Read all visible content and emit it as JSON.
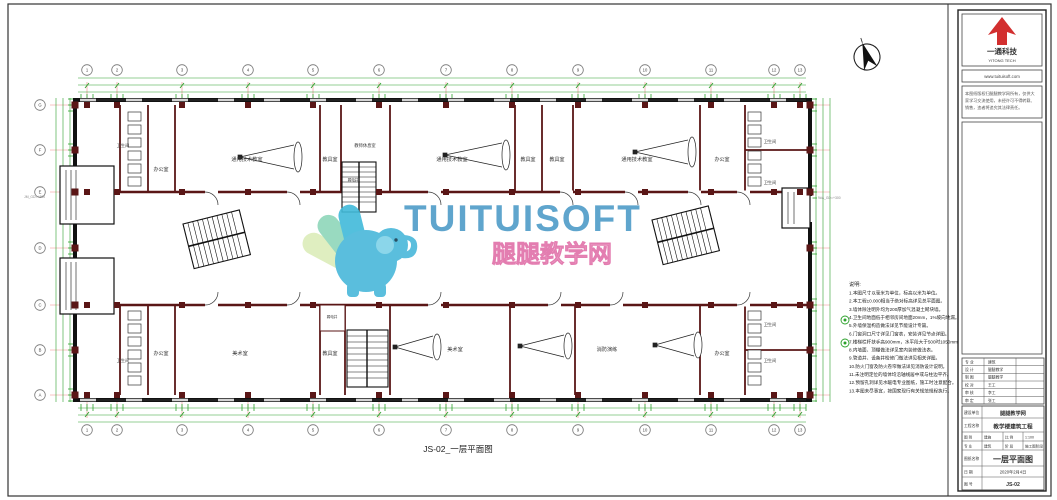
{
  "sheet": {
    "drawing_label": "JS-02_一层平面图"
  },
  "watermark": {
    "brand": "TUITUISOFT",
    "brand_cn": "腿腿教学网",
    "brand_color": "#4e9cc8",
    "cn_color": "#e87fb0",
    "elephant_color": "#49b8da"
  },
  "plan": {
    "axes_top": [
      "1",
      "2",
      "3",
      "4",
      "5",
      "6",
      "7",
      "8",
      "9",
      "10",
      "11",
      "12",
      "13"
    ],
    "axes_left": [
      "G",
      "F",
      "E",
      "D",
      "C",
      "B",
      "A"
    ],
    "rooms_top": [
      "卫生间",
      "办公室",
      "通用技术教室",
      "教具室",
      "教师休息室",
      "弱电井",
      "通用技术教室",
      "教具室",
      "教具室",
      "通用技术教室",
      "办公室",
      "卫生间",
      "卫生间"
    ],
    "rooms_bottom": [
      "卫生间",
      "办公室",
      "美术室",
      "弱电井",
      "教具室",
      "美术室",
      "消防演练",
      "办公室",
      "卫生间",
      "卫生间"
    ],
    "annotations": {
      "left": "JM_GD=+300",
      "right": "9#A_GD=+300"
    }
  },
  "notes": {
    "title": "说明:",
    "lines": [
      "1.本图尺寸以毫米为单位，标高以米为单位。",
      "2.本工程±0.000相当于绝对标高详见总平面图。",
      "3.墙体除注明外均为200厚加气混凝土砌块墙。",
      "4.卫生间地面低于相邻房间地面20mm，1%坡向地漏。",
      "5.外墙保温构造做法详见节能设计专篇。",
      "6.门窗洞口尺寸详见门窗表，安装详见节点详图。",
      "7.楼梯栏杆扶手高900mm，水平段大于500时1050mm。",
      "8.内墙面、顶棚做法详见室内装修做法表。",
      "9.管道井、设备井检修门做法详见相关详图。",
      "10.防火门窗及防火卷帘做法详见消防设计说明。",
      "11.未注明定位的墙体均沿轴线居中或与柱边平齐。",
      "12.预留孔洞详见水暖电专业图纸，施工时注意配合。",
      "13.本图未尽事宜，按国家现行有关规范规程执行。"
    ]
  },
  "title_block": {
    "logo": {
      "cn": "一通科技",
      "en": "YITONG TECH",
      "color": "#d22f2f"
    },
    "website": "www.tuituisoft.com",
    "disclaimer": [
      "本图纸版权归腿腿教学网所有，仅供大",
      "家学习交流使用，未经许可不得转载、",
      "销售，违者将追究其法律责任。"
    ],
    "sign_table": {
      "rows": [
        {
          "label": "专 业",
          "value": "建筑"
        },
        {
          "label": "设 计",
          "value": "腿腿教学"
        },
        {
          "label": "制 图",
          "value": "腿腿教学"
        },
        {
          "label": "校 对",
          "value": "王工"
        },
        {
          "label": "审 核",
          "value": "李工"
        },
        {
          "label": "审 定",
          "value": "张工"
        }
      ]
    },
    "project": {
      "owner_label": "建设单位",
      "owner": "腿腿教学网",
      "project_label": "工程名称",
      "project": "教学楼建筑工程",
      "grid1": [
        "图 别",
        "建施",
        "比 例",
        "1:100"
      ],
      "grid2": [
        "专 业",
        "建筑",
        "阶 段",
        "施工图阶段"
      ],
      "name_label": "图纸名称",
      "name": "一层平面图",
      "date_label": "日 期",
      "date": "2020年2月4日",
      "no_label": "图 号",
      "no": "JS-02"
    }
  }
}
